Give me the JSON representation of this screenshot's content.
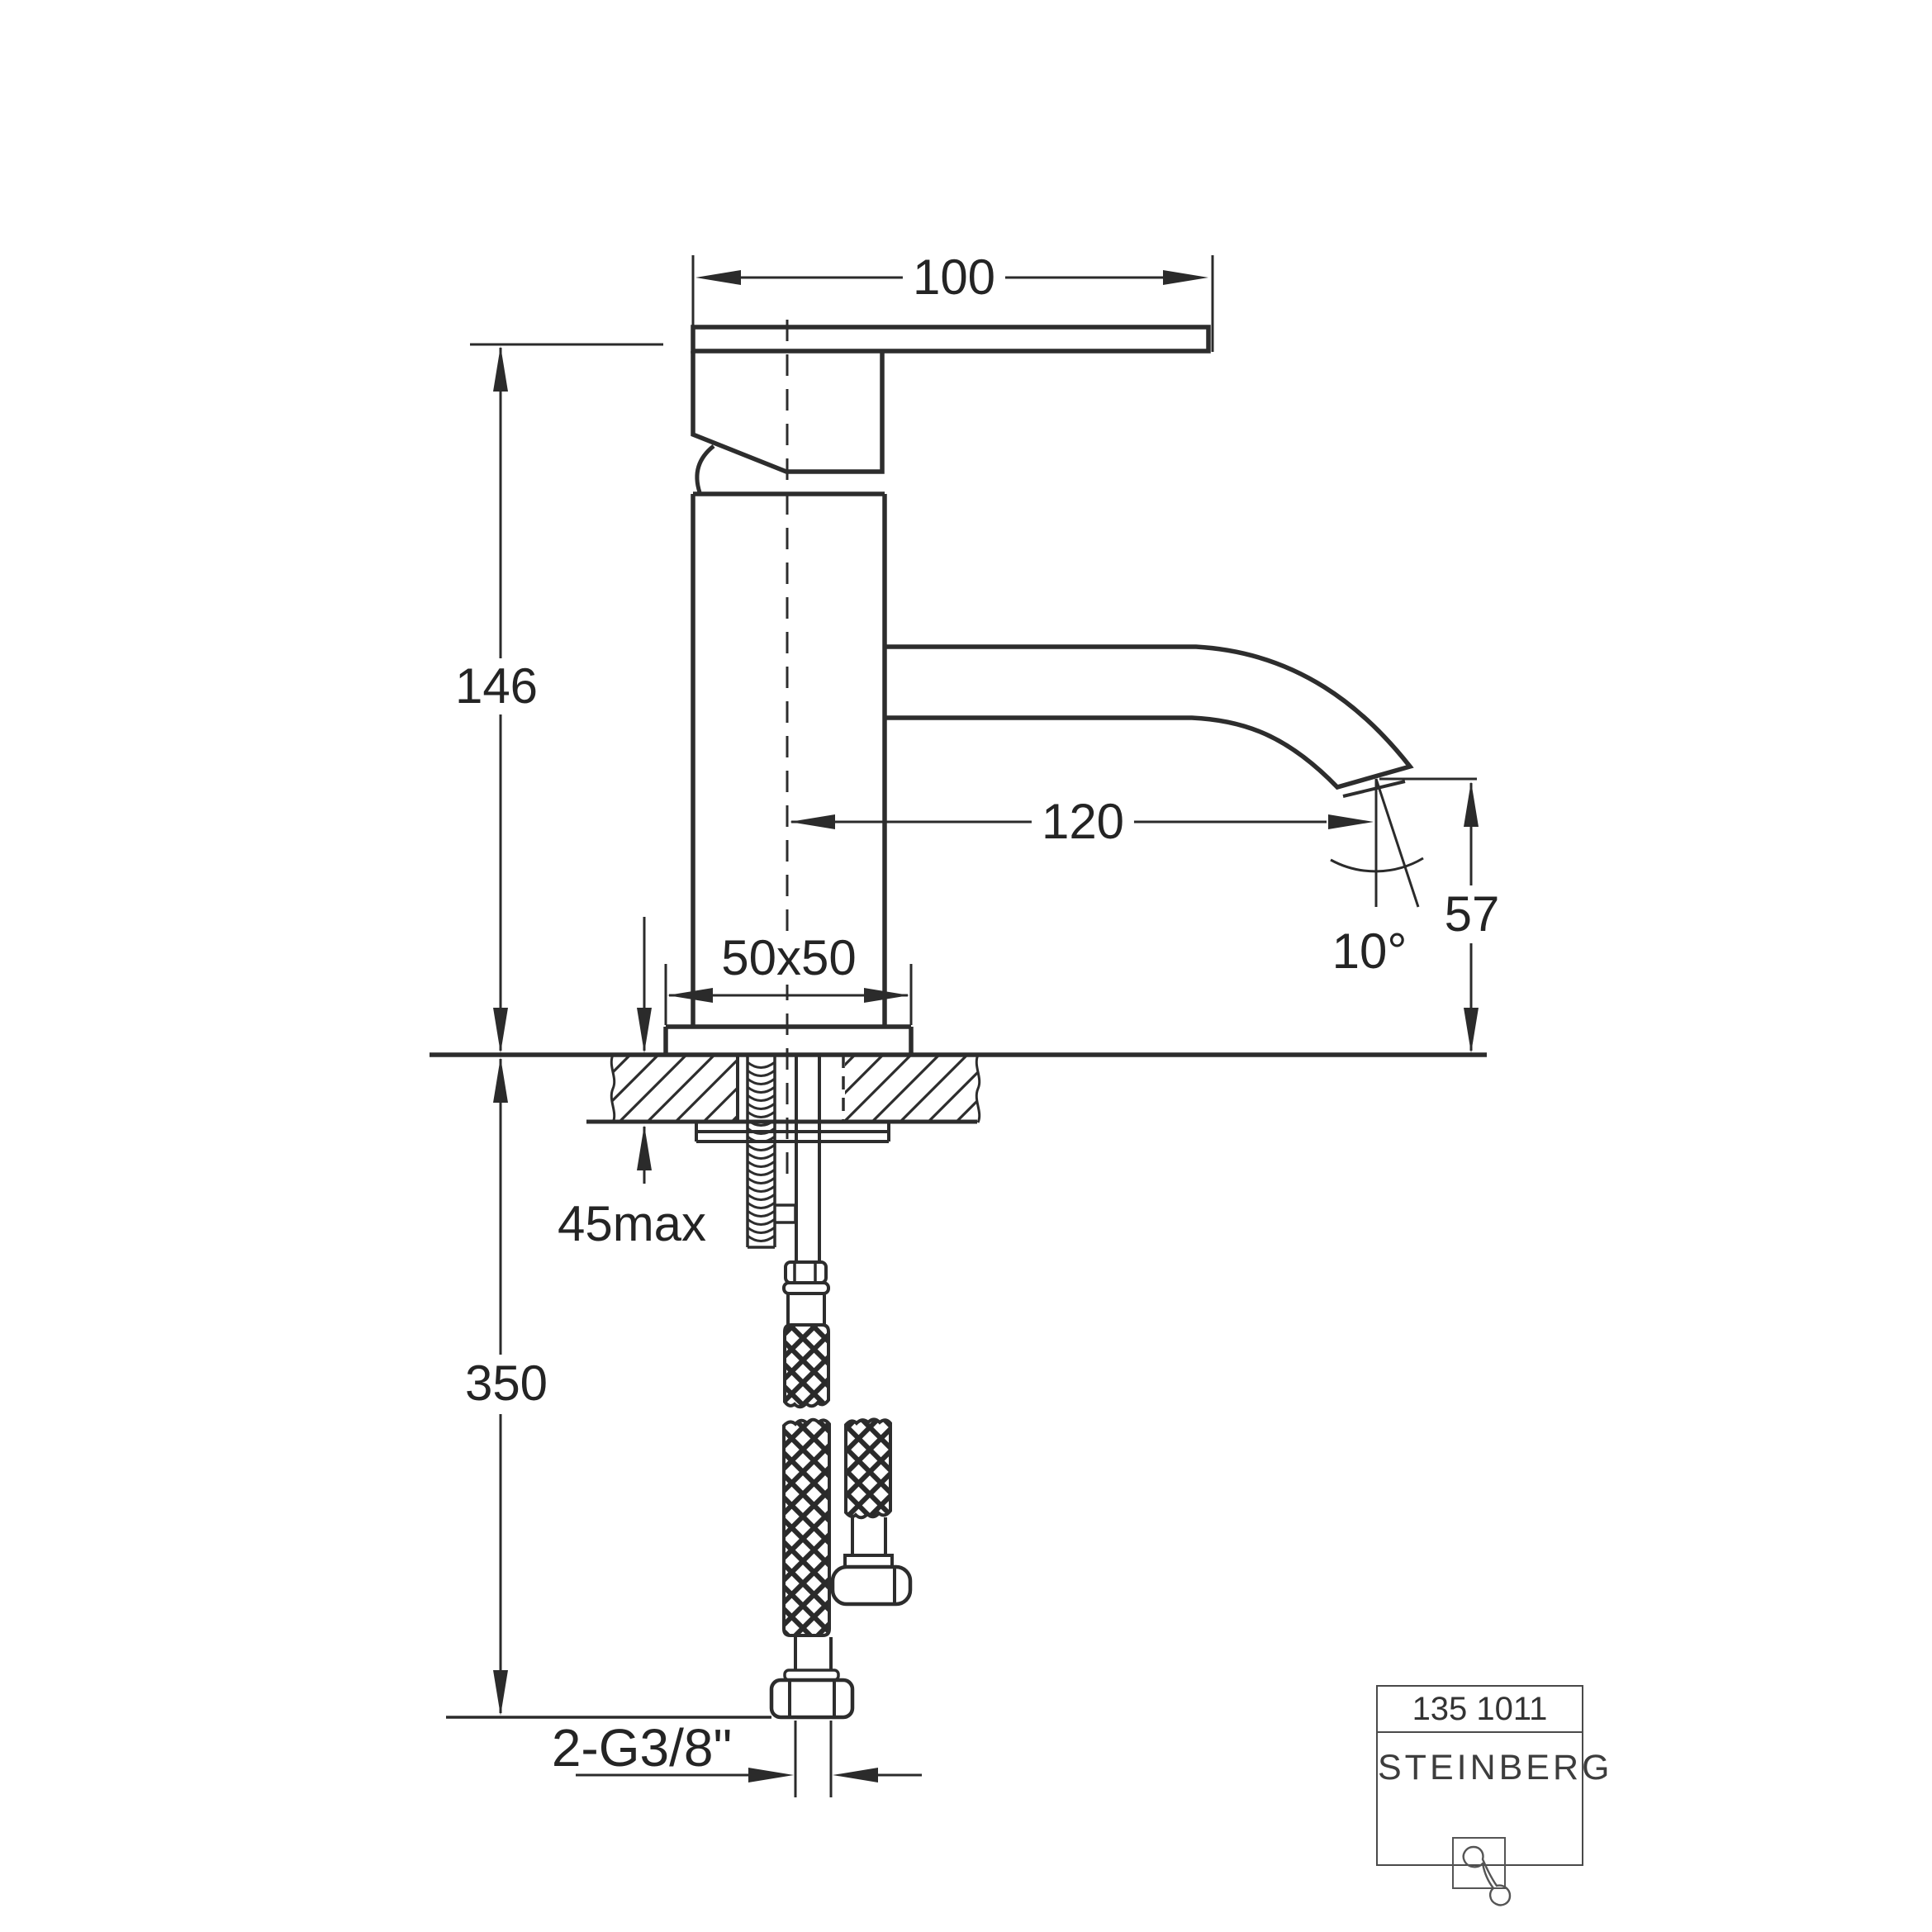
{
  "dimensions": {
    "handle_width": "100",
    "total_height": "146",
    "spout_reach": "120",
    "spout_height": "57",
    "spout_angle": "10°",
    "base_plate": "50x50",
    "max_deck_thickness": "45max",
    "hose_length": "350",
    "supply_connection": "2-G3/8\""
  },
  "title_block": {
    "article_number": "135 1011",
    "brand": "STEINBERG"
  }
}
